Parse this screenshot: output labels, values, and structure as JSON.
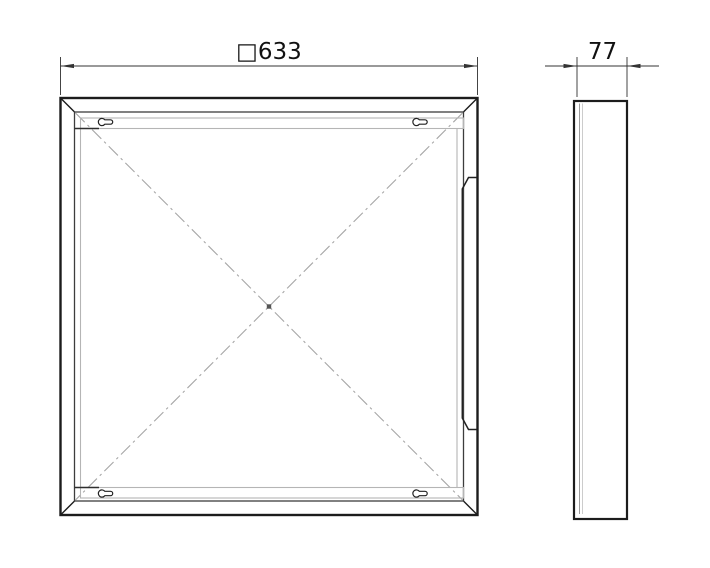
{
  "front_view": {
    "dimension": {
      "label": "□633",
      "value": 633,
      "prefix_symbol": "square-symbol"
    },
    "features": {
      "mounting_slots": "keyhole-slots-x4",
      "centerlines": "dash-dot-diagonals",
      "corner_detail": "chamfered-corners",
      "right_edge_detail": "latch-recess"
    }
  },
  "side_view": {
    "dimension": {
      "label": "77",
      "value": 77
    }
  },
  "colors": {
    "background": "#ffffff",
    "line_dark": "#1c1c1c",
    "line_medium": "#3d3d3d",
    "line_light": "#b5b5b5",
    "centerline": "#a6a6a6",
    "dimension_line": "#333333",
    "text": "#111111"
  }
}
